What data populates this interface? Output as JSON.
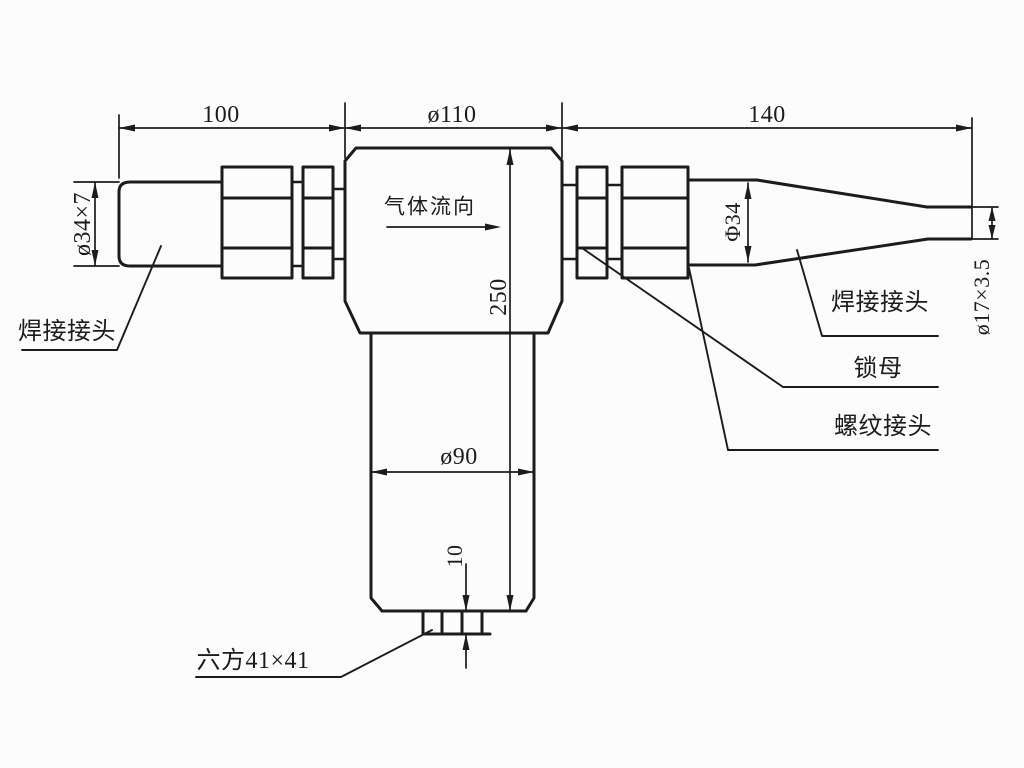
{
  "colors": {
    "line": "#1c1c1c",
    "paper": "#fcfcfc"
  },
  "dimensions": {
    "inlet_length": "100",
    "body_width": "ø110",
    "outlet_length": "140",
    "inlet_pipe": "ø34×7",
    "outlet_cone": "Φ34",
    "outlet_tube": "ø17×3.5",
    "overall_height": "250",
    "bowl_diameter": "ø90",
    "hex_boss_height": "10"
  },
  "labels": {
    "flow_direction": "气体流向",
    "inlet_weld_joint": "焊接接头",
    "outlet_weld_joint": "焊接接头",
    "lock_nut": "锁母",
    "threaded_joint": "螺纹接头",
    "hex_callout": "六方41×41"
  }
}
